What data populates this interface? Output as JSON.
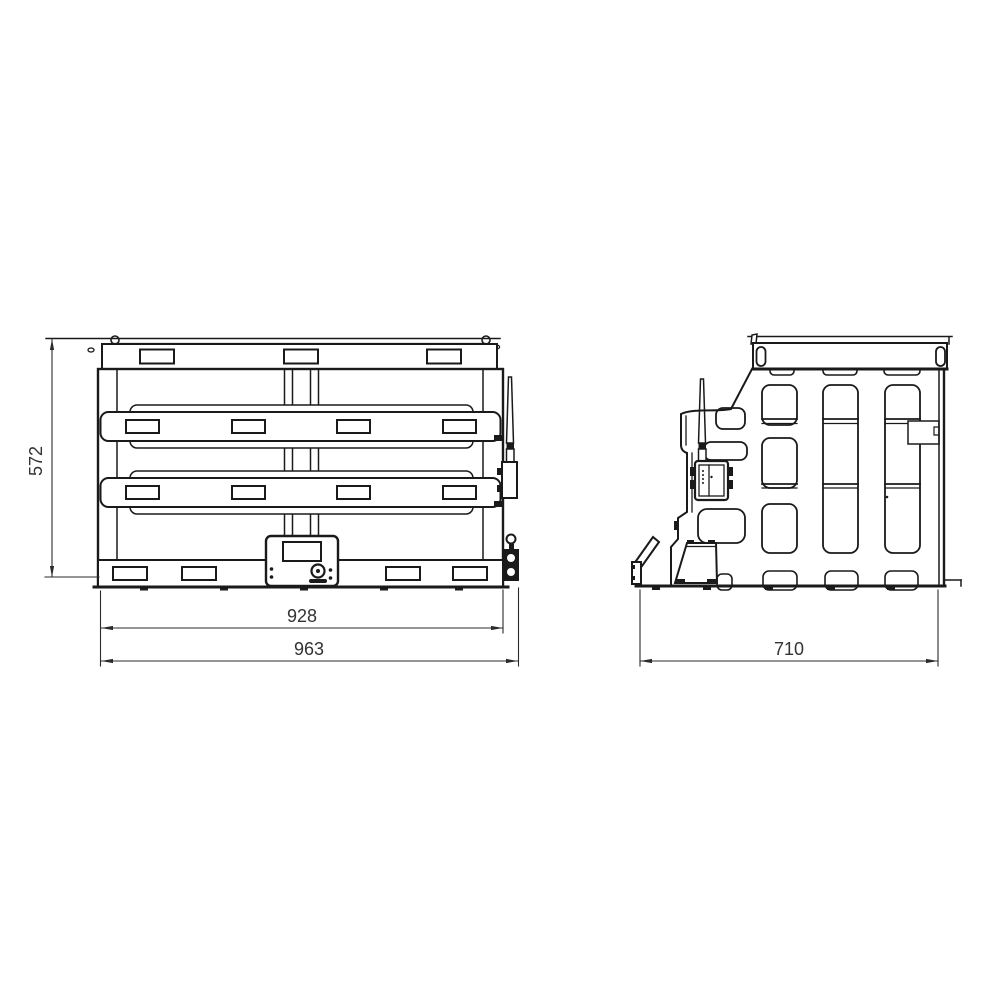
{
  "page": {
    "background": "#ffffff"
  },
  "drawing": {
    "line_color": "#1a1a1a",
    "dim_color": "#333333",
    "front_view": {
      "height_label": "572",
      "inner_width_label": "928",
      "overall_width_label": "963"
    },
    "side_view": {
      "width_label": "710"
    }
  }
}
